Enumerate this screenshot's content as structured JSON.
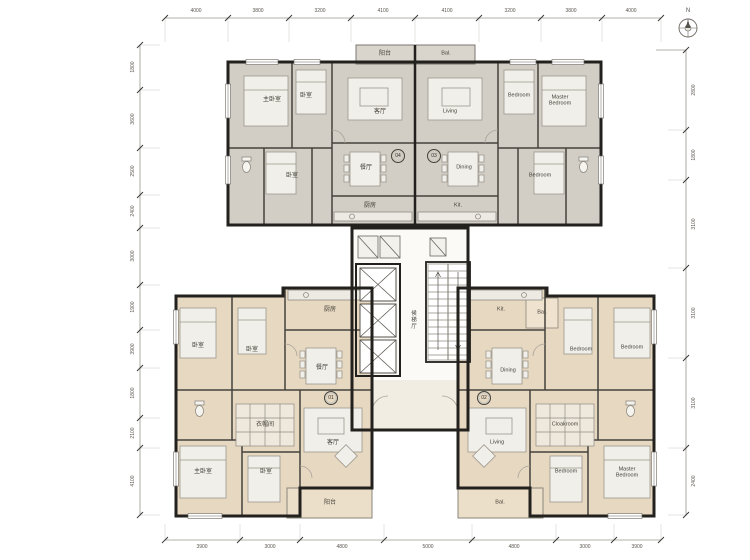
{
  "north_label": "N",
  "core": {
    "lobby_label": "候梯厅"
  },
  "units": [
    {
      "id": "04",
      "rooms": {
        "master_bedroom": "主卧室",
        "bedroom_a": "卧室",
        "living": "客厅",
        "bedroom_b": "卧室",
        "dining": "餐厅",
        "kitchen": "厨房",
        "balcony": "阳台"
      }
    },
    {
      "id": "03",
      "rooms": {
        "living": "Living",
        "bedroom_a": "Bedroom",
        "master_bedroom": "Master Bedroom",
        "dining": "Dining",
        "bedroom_b": "Bedroom",
        "kitchen": "Kit.",
        "balcony": "Bal."
      }
    },
    {
      "id": "01",
      "rooms": {
        "bedroom_a": "卧室",
        "bedroom_b": "卧室",
        "kitchen": "厨房",
        "dining": "餐厅",
        "cloakroom": "衣帽间",
        "living": "客厅",
        "master_bedroom": "主卧室",
        "bedroom_c": "卧室",
        "balcony": "阳台"
      }
    },
    {
      "id": "02",
      "rooms": {
        "kitchen": "Kit.",
        "service_balcony": "Bal.",
        "dining": "Dining",
        "bedroom_a": "Bedroom",
        "bedroom_b": "Bedroom",
        "cloakroom": "Cloakroom",
        "living": "Living",
        "bedroom_c": "Bedroom",
        "master_bedroom": "Master Bedroom",
        "balcony": "Bal."
      }
    }
  ],
  "dimensions": {
    "top": [
      "4000",
      "3800",
      "3200",
      "4100",
      "4100",
      "3200",
      "3800",
      "4000"
    ],
    "bottom": [
      "3900",
      "3000",
      "4800",
      "5000",
      "4800",
      "3000",
      "3900"
    ],
    "left": [
      "1800",
      "3600",
      "2500",
      "2400",
      "3000",
      "1900",
      "3900",
      "1800",
      "2100",
      "4100"
    ],
    "right": [
      "2800",
      "1800",
      "3100",
      "3100",
      "3100",
      "2400"
    ]
  },
  "colors": {
    "upper_unit_floor": "#d2cec6",
    "lower_unit_floor": "#e7d8c1",
    "balcony_floor": "#ecdfc9",
    "wall": "#23211d"
  }
}
